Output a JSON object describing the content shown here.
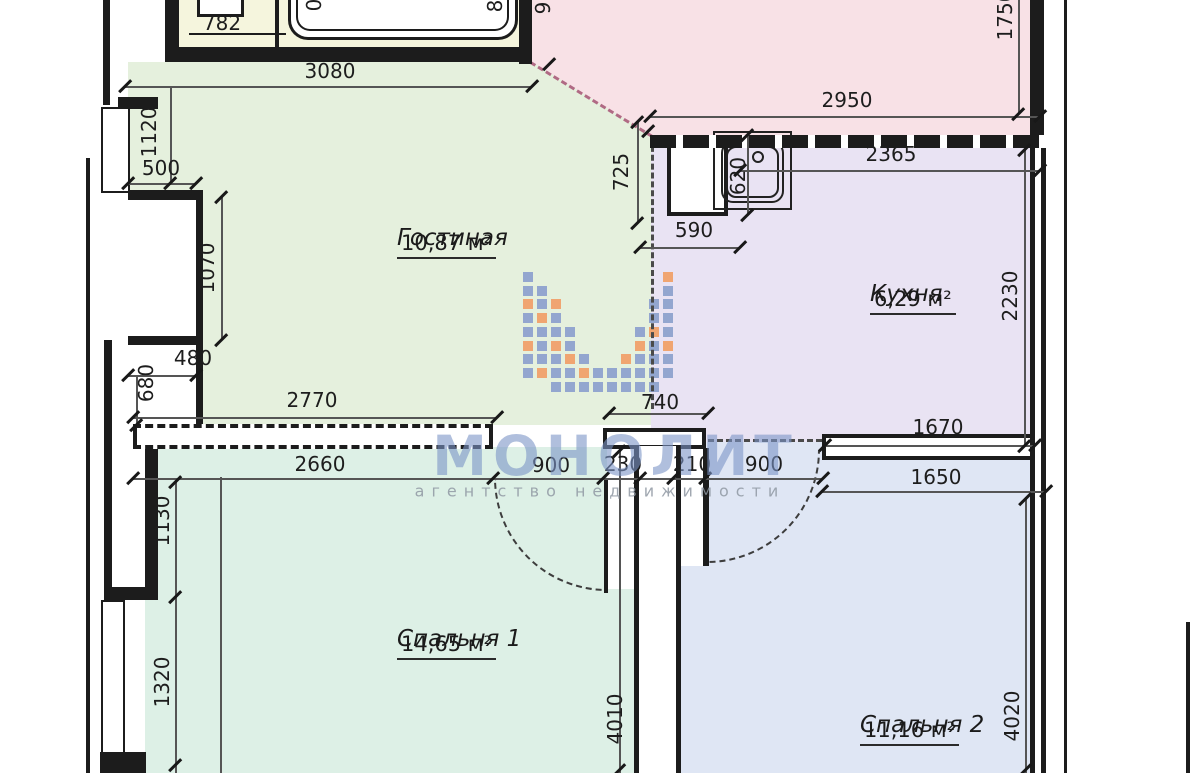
{
  "watermark": {
    "title": "МОНОЛИТ",
    "subtitle": "агентство недвижимости",
    "blue": "#93a6cf",
    "orange": "#f0a571",
    "title_color": "rgba(123,148,199,0.6)",
    "subtitle_color": "rgba(143,152,162,0.85)"
  },
  "colors": {
    "living": "#e5f0dd",
    "kitchen": "#e9e3f3",
    "bedroom1": "#ddf0e6",
    "bedroom2": "#dfe6f4",
    "hallway": "#f8e1e6",
    "bathroom": "#f5f5dd"
  },
  "rooms": [
    {
      "id": "living",
      "name": "Гостиная",
      "area": "10,87 м²"
    },
    {
      "id": "kitchen",
      "name": "Кухня",
      "area": "6,29 м²"
    },
    {
      "id": "bedroom1",
      "name": "Спальня 1",
      "area": "14,65 м²"
    },
    {
      "id": "bedroom2",
      "name": "Спальня 2",
      "area": "11,16 м²"
    }
  ],
  "dimensions": [
    {
      "text": "782",
      "x": 222,
      "y": 23,
      "rot": 0
    },
    {
      "text": "3080",
      "x": 330,
      "y": 71,
      "rot": 0
    },
    {
      "text": "1120",
      "x": 149,
      "y": 132,
      "rot": -90
    },
    {
      "text": "500",
      "x": 161,
      "y": 168,
      "rot": 0
    },
    {
      "text": "1070",
      "x": 207,
      "y": 268,
      "rot": -90
    },
    {
      "text": "480",
      "x": 193,
      "y": 358,
      "rot": 0
    },
    {
      "text": "680",
      "x": 146,
      "y": 383,
      "rot": -90
    },
    {
      "text": "2770",
      "x": 312,
      "y": 400,
      "rot": 0
    },
    {
      "text": "2950",
      "x": 847,
      "y": 100,
      "rot": 0
    },
    {
      "text": "1750",
      "x": 1005,
      "y": 15,
      "rot": -90
    },
    {
      "text": "725",
      "x": 621,
      "y": 172,
      "rot": -90
    },
    {
      "text": "590",
      "x": 694,
      "y": 230,
      "rot": 0
    },
    {
      "text": "620",
      "x": 738,
      "y": 176,
      "rot": -90
    },
    {
      "text": "2365",
      "x": 891,
      "y": 154,
      "rot": 0
    },
    {
      "text": "2230",
      "x": 1010,
      "y": 296,
      "rot": -90
    },
    {
      "text": "740",
      "x": 660,
      "y": 402,
      "rot": 0
    },
    {
      "text": "1670",
      "x": 938,
      "y": 427,
      "rot": 0
    },
    {
      "text": "2660",
      "x": 320,
      "y": 464,
      "rot": 0
    },
    {
      "text": "900",
      "x": 551,
      "y": 465,
      "rot": 0
    },
    {
      "text": "230",
      "x": 623,
      "y": 464,
      "rot": 0
    },
    {
      "text": "210",
      "x": 692,
      "y": 464,
      "rot": 0
    },
    {
      "text": "900",
      "x": 764,
      "y": 464,
      "rot": 0
    },
    {
      "text": "1650",
      "x": 936,
      "y": 477,
      "rot": 0
    },
    {
      "text": "1130",
      "x": 162,
      "y": 521,
      "rot": -90
    },
    {
      "text": "1320",
      "x": 162,
      "y": 682,
      "rot": -90
    },
    {
      "text": "4010",
      "x": 615,
      "y": 719,
      "rot": -90
    },
    {
      "text": "4020",
      "x": 1012,
      "y": 716,
      "rot": -90
    },
    {
      "text": "9",
      "x": 543,
      "y": 8,
      "rot": -90
    },
    {
      "text": "0",
      "x": 314,
      "y": 5,
      "rot": -90
    },
    {
      "text": "8",
      "x": 495,
      "y": 6,
      "rot": -90
    }
  ]
}
